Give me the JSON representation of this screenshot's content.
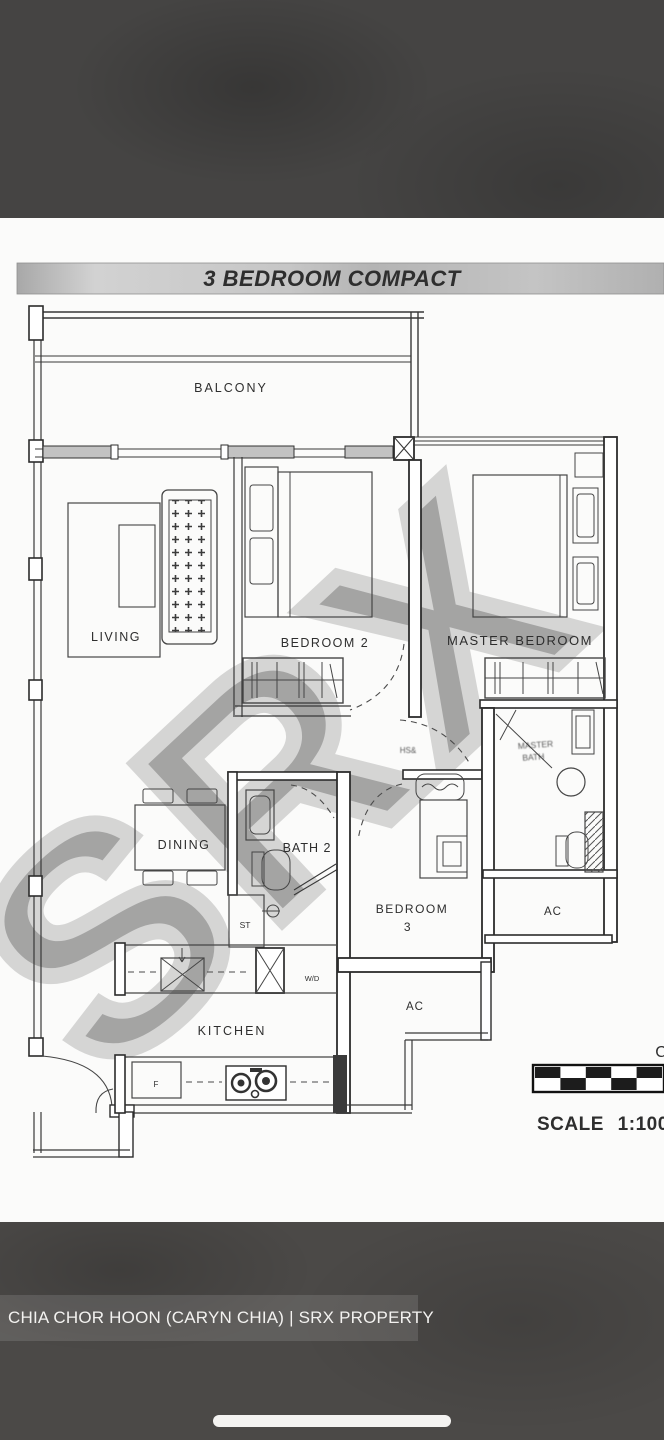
{
  "title_bar": {
    "label": "3 BEDROOM COMPACT"
  },
  "rooms": {
    "balcony": "BALCONY",
    "living": "LIVING",
    "dining": "DINING",
    "bedroom2": "BEDROOM 2",
    "master_bedroom": "MASTER BEDROOM",
    "bath2": "BATH 2",
    "bedroom3_line1": "BEDROOM",
    "bedroom3_line2": "3",
    "kitchen": "KITCHEN",
    "ac_right": "AC",
    "ac_bottom": "AC"
  },
  "fixtures": {
    "storage": "ST",
    "washer_dryer": "W/D",
    "fridge": "F",
    "master_bath_line1": "MASTER",
    "master_bath_line2": "BATH",
    "illegible_door_label": "HS&"
  },
  "scale_bar": {
    "label": "SCALE 1:100",
    "partial_char": "C"
  },
  "watermark": {
    "text": "SRX"
  },
  "caption": {
    "text": "CHIA CHOR HOON (CARYN CHIA) | SRX PROPERTY"
  },
  "colors": {
    "letterbox_top": "#454443",
    "letterbox_bottom": "#4b4947",
    "paper": "#fbfbfa",
    "wall_ink": "#383838",
    "title_bar_gray": "#bfbfbf",
    "watermark_gray": "#a2a2a2",
    "caption_text": "#f3f2f0"
  }
}
